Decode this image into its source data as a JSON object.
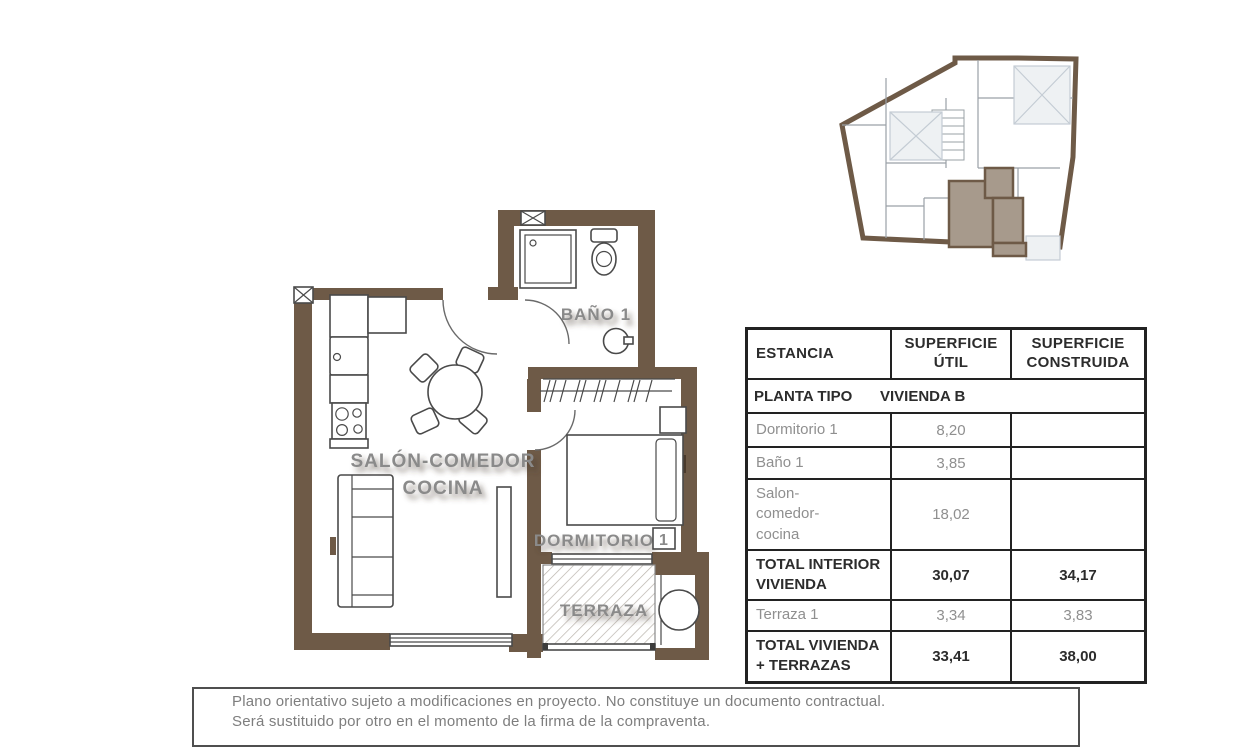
{
  "plan": {
    "labels": {
      "salon_line1": "SALÓN-COMEDOR",
      "salon_line2": "COCINA",
      "bano": "BAÑO 1",
      "dormitorio": "DORMITORIO",
      "dormitorio_num": "1",
      "terraza": "TERRAZA"
    },
    "colors": {
      "wall": "#6e5a47",
      "unit_highlight": "#a79a8c",
      "label_gray": "#8a8a8a"
    }
  },
  "table": {
    "header": {
      "estancia": "ESTANCIA",
      "util": "SUPERFICIE ÚTIL",
      "construida": "SUPERFICIE CONSTRUIDA"
    },
    "subheader": {
      "planta": "PLANTA TIPO",
      "vivienda": "VIVIENDA B"
    },
    "rows": [
      {
        "name": "Dormitorio 1",
        "util": "8,20",
        "construida": ""
      },
      {
        "name": "Baño 1",
        "util": "3,85",
        "construida": ""
      },
      {
        "name": "Salon-\ncomedor-\ncocina",
        "util": "18,02",
        "construida": ""
      },
      {
        "name": "TOTAL INTERIOR\nVIVIENDA",
        "util": "30,07",
        "construida": "34,17"
      },
      {
        "name": "Terraza 1",
        "util": "3,34",
        "construida": "3,83"
      },
      {
        "name": "TOTAL VIVIENDA\n+ TERRAZAS",
        "util": "33,41",
        "construida": "38,00"
      }
    ]
  },
  "footer": {
    "line1": "Plano orientativo sujeto a modificaciones en proyecto. No constituye un documento contractual.",
    "line2": "Será sustituido por otro en el momento de la firma de la compraventa."
  }
}
